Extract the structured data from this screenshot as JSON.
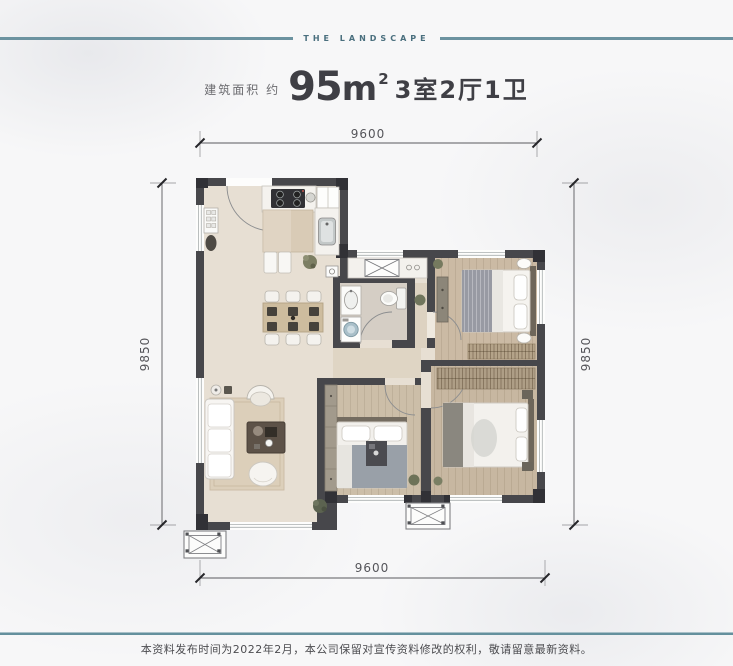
{
  "header": {
    "brand": "THE LANDSCAPE"
  },
  "title": {
    "prefix": "建筑面积 约",
    "area_number": "95",
    "area_unit": "m",
    "area_exponent": "2",
    "rooms": "3室2厅1卫"
  },
  "dimensions": {
    "top": "9600",
    "bottom": "9600",
    "left": "9850",
    "right": "9850"
  },
  "footer": {
    "disclaimer": "本资料发布时间为2022年2月，本公司保留对宣传资料修改的权利，敬请留意最新资料。"
  },
  "colors": {
    "accent_line": "#6c93a0",
    "wall": "#47474b",
    "floor": "#e7dfd3",
    "wood": "#cbbaa4",
    "dimension": "#55555a"
  }
}
